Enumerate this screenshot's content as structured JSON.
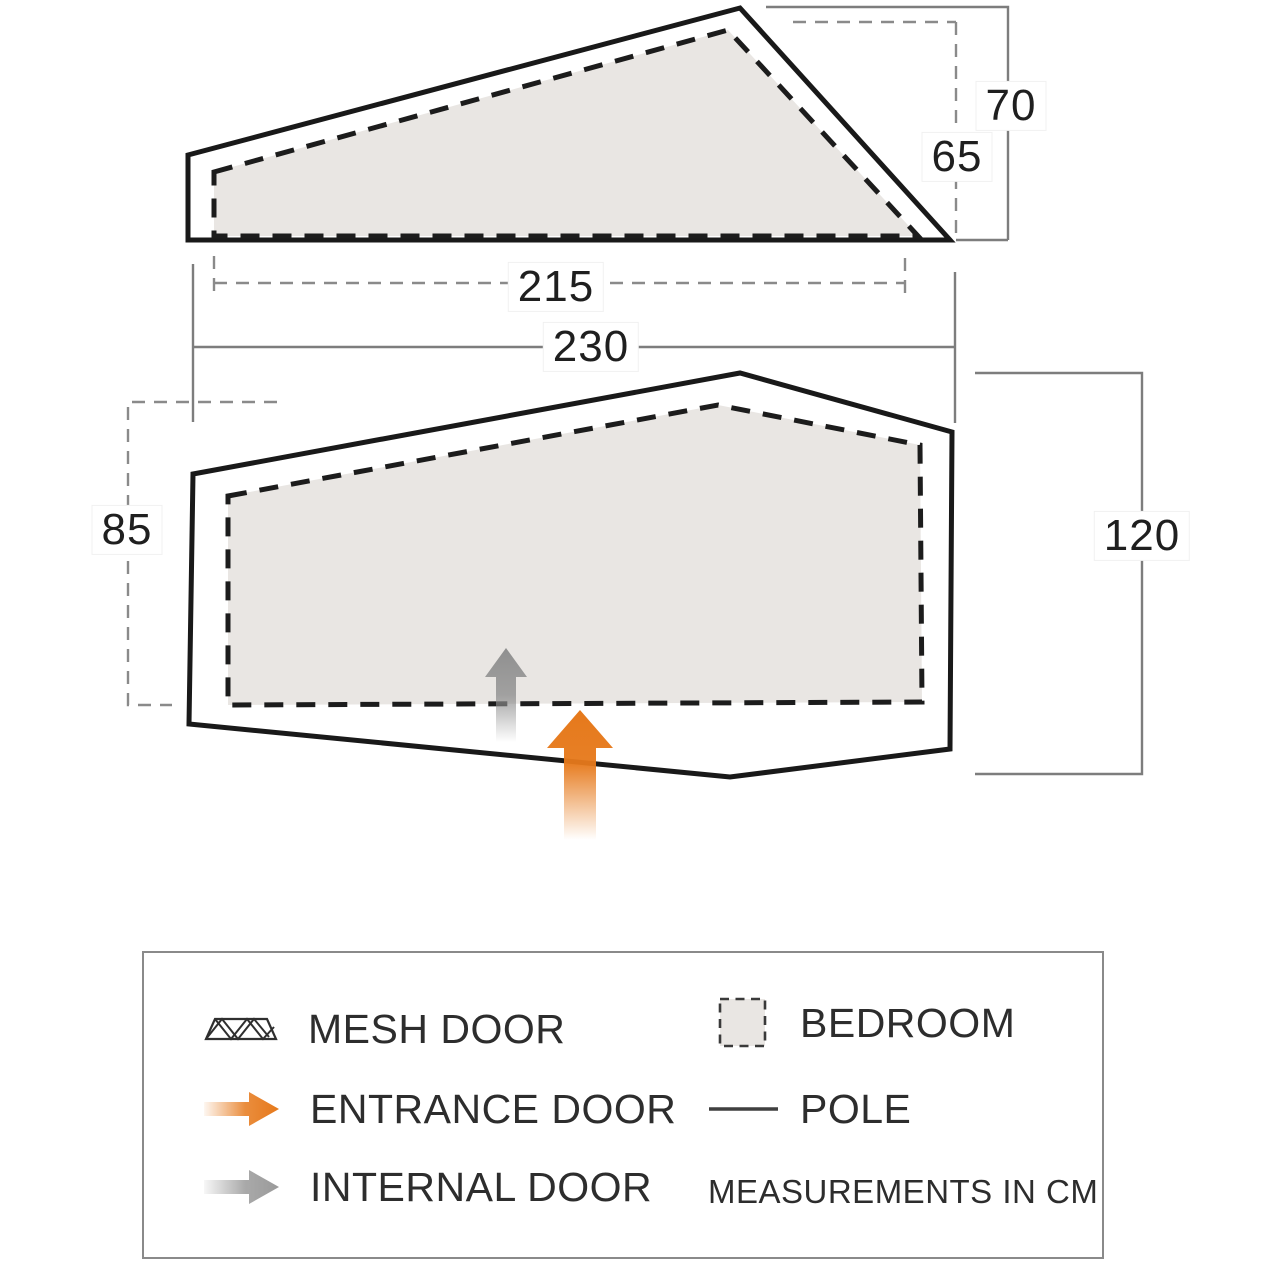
{
  "dimensions": {
    "side_height_outer": "70",
    "side_height_inner": "65",
    "side_width_inner": "215",
    "floor_width": "230",
    "floor_depth_left": "85",
    "floor_depth_right": "120"
  },
  "legend": {
    "items": [
      {
        "icon": "mesh-door-icon",
        "label": "MESH DOOR"
      },
      {
        "icon": "entrance-door-icon",
        "label": "ENTRANCE DOOR"
      },
      {
        "icon": "internal-door-icon",
        "label": "INTERNAL DOOR"
      },
      {
        "icon": "bedroom-swatch-icon",
        "label": "BEDROOM"
      },
      {
        "icon": "pole-icon",
        "label": "POLE"
      }
    ],
    "note": "MEASUREMENTS IN CM"
  },
  "colors": {
    "entrance_door": "#e6791b",
    "internal_door": "#8f8f8f",
    "bedroom_fill": "#e9e6e3",
    "outline": "#191919",
    "dimension_line": "#7d7d7d"
  }
}
